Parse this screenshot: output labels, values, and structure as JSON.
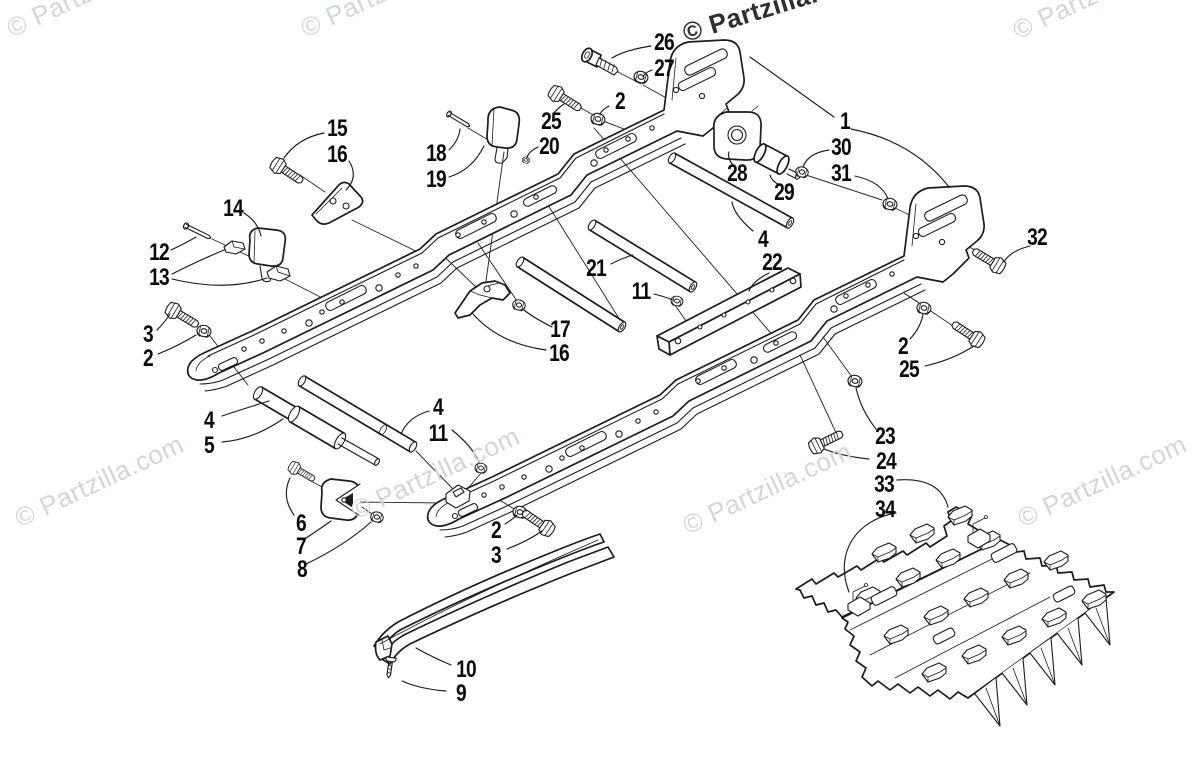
{
  "page": {
    "background": "#ffffff",
    "line_color": "#1c1c1c",
    "description": "Exploded technical parts diagram of a slide rail and track assembly with numbered callouts"
  },
  "watermark": {
    "text": "© Partzilla.com",
    "light_color": "#cfd8d5",
    "dark_color": "#2e2e2e",
    "instances": [
      {
        "x": 2,
        "y": 16,
        "angle": -25,
        "variant": "light"
      },
      {
        "x": 296,
        "y": 16,
        "angle": -25,
        "variant": "light"
      },
      {
        "x": 1008,
        "y": 18,
        "angle": -25,
        "variant": "light"
      },
      {
        "x": 679,
        "y": 19,
        "angle": -17,
        "variant": "dark"
      },
      {
        "x": 10,
        "y": 506,
        "angle": -25,
        "variant": "light"
      },
      {
        "x": 346,
        "y": 498,
        "angle": -25,
        "variant": "light"
      },
      {
        "x": 678,
        "y": 513,
        "angle": -25,
        "variant": "light"
      },
      {
        "x": 1013,
        "y": 506,
        "angle": -25,
        "variant": "light"
      }
    ]
  },
  "callouts": [
    {
      "n": "1",
      "x": 845,
      "y": 122
    },
    {
      "n": "2",
      "x": 620,
      "y": 102
    },
    {
      "n": "2",
      "x": 903,
      "y": 347
    },
    {
      "n": "2",
      "x": 148,
      "y": 359
    },
    {
      "n": "2",
      "x": 496,
      "y": 531
    },
    {
      "n": "3",
      "x": 148,
      "y": 335
    },
    {
      "n": "3",
      "x": 496,
      "y": 556
    },
    {
      "n": "4",
      "x": 763,
      "y": 240
    },
    {
      "n": "4",
      "x": 209,
      "y": 421
    },
    {
      "n": "4",
      "x": 438,
      "y": 408
    },
    {
      "n": "5",
      "x": 209,
      "y": 446
    },
    {
      "n": "6",
      "x": 301,
      "y": 524
    },
    {
      "n": "7",
      "x": 301,
      "y": 547
    },
    {
      "n": "8",
      "x": 302,
      "y": 570
    },
    {
      "n": "9",
      "x": 461,
      "y": 694
    },
    {
      "n": "10",
      "x": 466,
      "y": 670
    },
    {
      "n": "11",
      "x": 641,
      "y": 292
    },
    {
      "n": "11",
      "x": 438,
      "y": 434
    },
    {
      "n": "12",
      "x": 159,
      "y": 253
    },
    {
      "n": "13",
      "x": 159,
      "y": 278
    },
    {
      "n": "14",
      "x": 233,
      "y": 209
    },
    {
      "n": "15",
      "x": 337,
      "y": 129
    },
    {
      "n": "16",
      "x": 337,
      "y": 155
    },
    {
      "n": "16",
      "x": 559,
      "y": 354
    },
    {
      "n": "17",
      "x": 560,
      "y": 330
    },
    {
      "n": "18",
      "x": 436,
      "y": 154
    },
    {
      "n": "19",
      "x": 436,
      "y": 180
    },
    {
      "n": "20",
      "x": 549,
      "y": 147
    },
    {
      "n": "21",
      "x": 596,
      "y": 269
    },
    {
      "n": "22",
      "x": 772,
      "y": 263
    },
    {
      "n": "23",
      "x": 885,
      "y": 437
    },
    {
      "n": "24",
      "x": 886,
      "y": 462
    },
    {
      "n": "25",
      "x": 551,
      "y": 122
    },
    {
      "n": "25",
      "x": 909,
      "y": 370
    },
    {
      "n": "26",
      "x": 664,
      "y": 43
    },
    {
      "n": "27",
      "x": 664,
      "y": 69
    },
    {
      "n": "28",
      "x": 737,
      "y": 174
    },
    {
      "n": "29",
      "x": 784,
      "y": 193
    },
    {
      "n": "30",
      "x": 841,
      "y": 148
    },
    {
      "n": "31",
      "x": 841,
      "y": 174
    },
    {
      "n": "32",
      "x": 1037,
      "y": 238
    },
    {
      "n": "33",
      "x": 884,
      "y": 485
    },
    {
      "n": "34",
      "x": 885,
      "y": 510
    }
  ],
  "parts_depicted": [
    "slide-rail-left",
    "slide-rail-right",
    "cross-tubes",
    "rear-axle",
    "rail-brace",
    "suspension-blocks",
    "idler-roller",
    "wear-strip",
    "track-segment",
    "track-clips",
    "bolts-nuts-washers"
  ]
}
